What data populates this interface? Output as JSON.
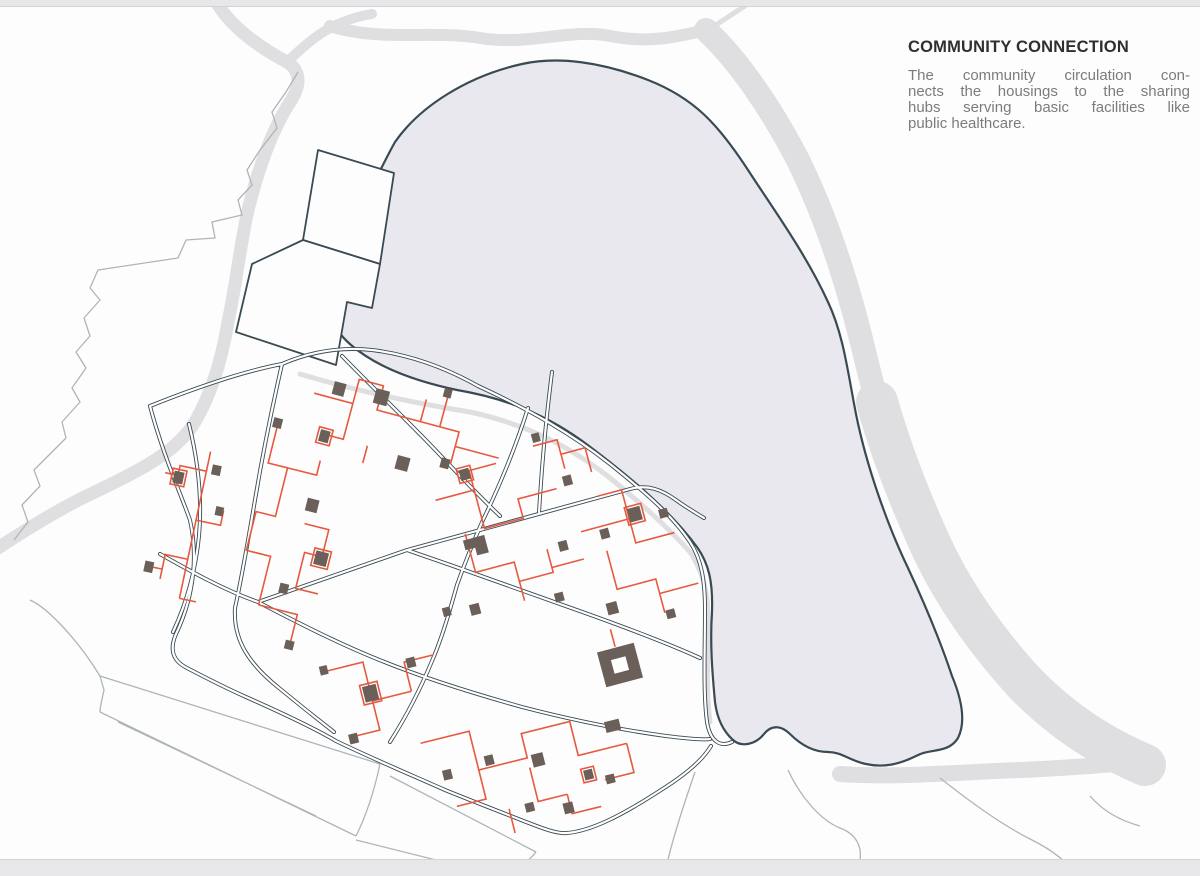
{
  "panel": {
    "title": "COMMUNITY CONNECTION",
    "body_lines": [
      "The community circulation con-",
      "nects the housings to the sharing",
      "hubs serving basic facilities like",
      "public healthcare."
    ]
  },
  "map": {
    "type": "architectural site plan diagram",
    "features": [
      {
        "name": "lake",
        "style": "light lavender fill with dark outline"
      },
      {
        "name": "street-network",
        "style": "dark double lines"
      },
      {
        "name": "community-circulation-network",
        "style": "orange rectilinear paths"
      },
      {
        "name": "sharing-hub-buildings",
        "style": "small dark taupe blocks, some outlined orange"
      },
      {
        "name": "river-bands",
        "style": "wide light gray bands"
      },
      {
        "name": "terrain-contours",
        "style": "thin gray lines"
      }
    ],
    "colors": {
      "street": "#3a4a52",
      "circulation": "#e7593f",
      "hub": "#6b5f59",
      "lake": "#e8e8ee",
      "river": "#dfdfe1",
      "contour": "#adb5b9"
    }
  }
}
